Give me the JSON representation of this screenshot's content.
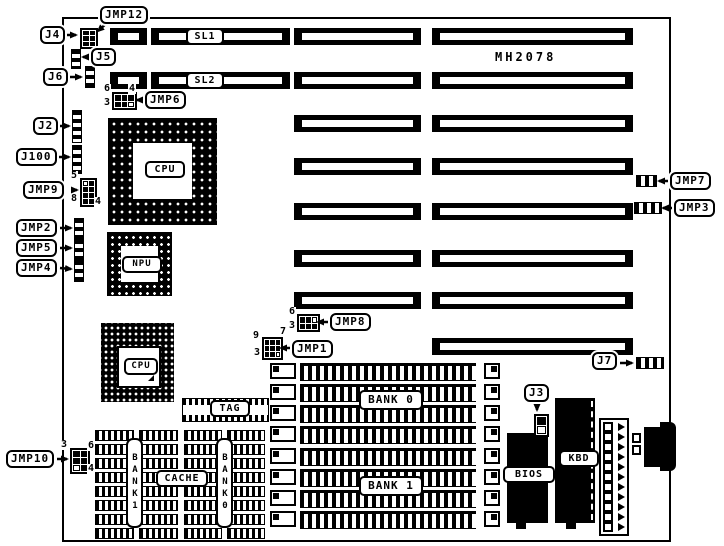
{
  "board": {
    "part_number": "MH2078"
  },
  "labels": {
    "sl1": "SL1",
    "sl2": "SL2",
    "cpu_socket": "CPU",
    "npu_socket": "NPU",
    "cpu_qfp": "CPU",
    "tag": "TAG",
    "cache": "CACHE",
    "bank1_chip_col": "BANK1",
    "bank0_chip_col": "BANK0",
    "bank0_simm": "BANK 0",
    "bank1_simm": "BANK 1",
    "bios": "BIOS",
    "kbd": "KBD"
  },
  "callouts": {
    "jmp12": "JMP12",
    "j4": "J4",
    "j5": "J5",
    "j6": "J6",
    "jmp6": "JMP6",
    "j2": "J2",
    "j100": "J100",
    "jmp9": "JMP9",
    "jmp2": "JMP2",
    "jmp5": "JMP5",
    "jmp4": "JMP4",
    "jmp10": "JMP10",
    "jmp8": "JMP8",
    "jmp1": "JMP1",
    "jmp7": "JMP7",
    "jmp3": "JMP3",
    "j7": "J7",
    "j3": "J3"
  },
  "pins": {
    "jmp6": {
      "tl": "6",
      "tr": "4",
      "bl": "3"
    },
    "jmp9": {
      "tl": "5",
      "bl": "8",
      "br": "4"
    },
    "jmp8": {
      "tl": "6",
      "bl": "3"
    },
    "jmp1": {
      "tl": "9",
      "tr": "7",
      "bl": "3"
    },
    "jmp10": {
      "tl": "3",
      "tr": "6",
      "br": "4"
    }
  },
  "colors": {
    "ink": "#000000",
    "paper": "#ffffff"
  }
}
